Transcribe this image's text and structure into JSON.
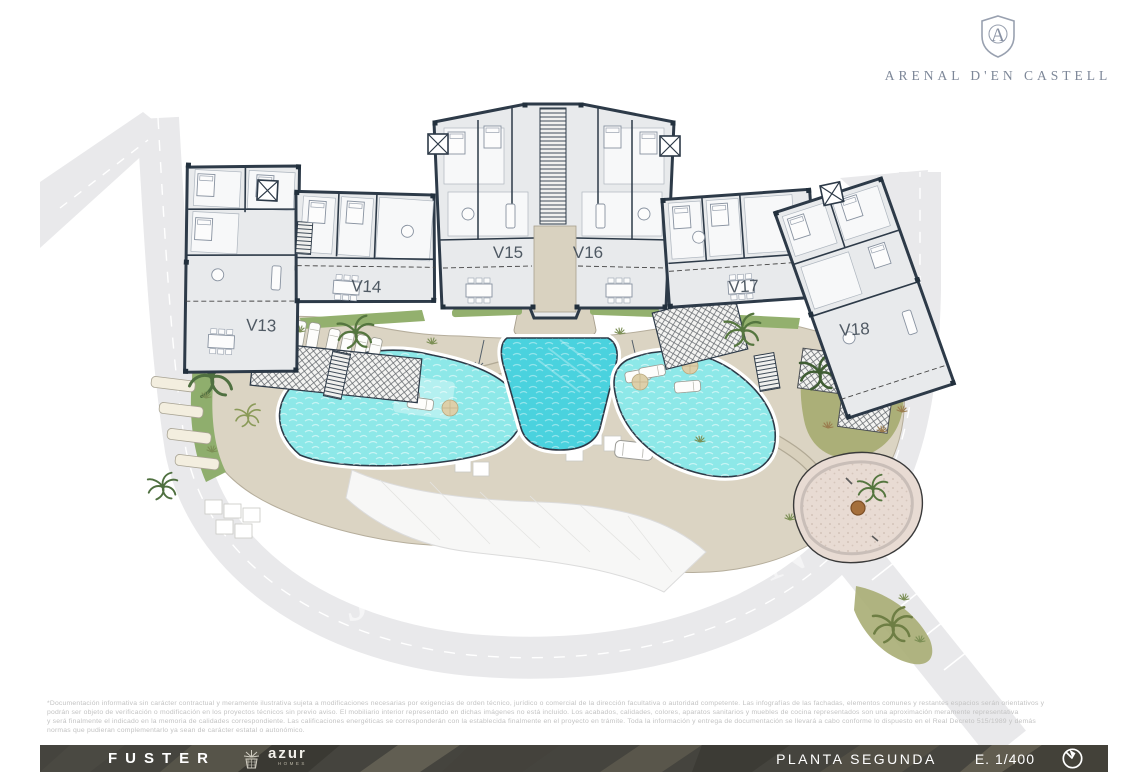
{
  "header": {
    "brand": "ARENAL D'EN CASTELL",
    "monogram": "A"
  },
  "plan": {
    "units": [
      {
        "label": "V13"
      },
      {
        "label": "V14"
      },
      {
        "label": "V15"
      },
      {
        "label": "V16"
      },
      {
        "label": "V17"
      },
      {
        "label": "V18"
      }
    ],
    "watermark": {
      "left": "JON",
      "right": "ON"
    }
  },
  "disclaimer": {
    "lines": [
      "*Documentación informativa sin carácter contractual y meramente ilustrativa sujeta a modificaciones necesarias por exigencias de orden técnico, jurídico o comercial de la dirección facultativa o autoridad competente. Las infografías de las fachadas, elementos comunes y restantes espacios serán orientativos y",
      "podrán ser objeto de verificación o modificación en los proyectos técnicos sin previo aviso. El mobiliario interior representado en dichas imágenes no está incluido. Los acabados, calidades, colores, aparatos sanitarios y muebles de cocina representados son una aproximación meramente representativa",
      "y será finalmente el indicado en la memoria de calidades correspondiente. Las calificaciones energéticas se corresponderán con la establecida finalmente en el proyecto en trámite. Toda la información y entrega de documentación se llevará a cabo conforme lo dispuesto en el Real Decreto 515/1989 y demás",
      "normas que pudieran complementarlo ya sean de carácter estatal o autonómico."
    ]
  },
  "footer": {
    "developer": "FUSTER",
    "agency": {
      "name": "azur",
      "sub": "HOMES"
    },
    "plan_label": "PLANTA SEGUNDA",
    "scale": "E. 1/400"
  },
  "colors": {
    "wall": "#2d3a48",
    "pool_light": "#8de8e8",
    "pool_deep": "#4ad2de",
    "ground_beige": "#dbd4c3",
    "brand_gray": "#7d8798",
    "footer_dark": "#45443e"
  }
}
